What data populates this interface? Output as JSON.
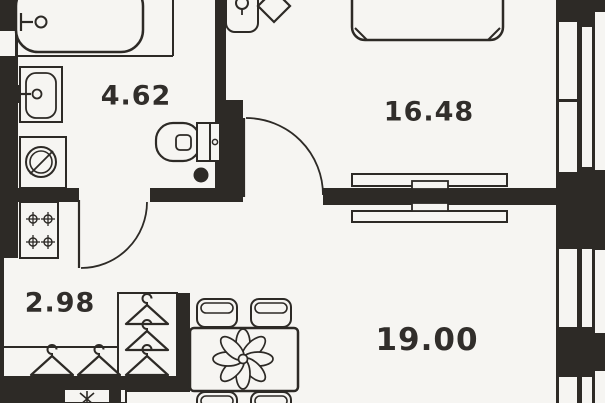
{
  "plan": {
    "type": "apartment-floor-plan",
    "colors": {
      "bg": "#f6f5f2",
      "wall": "#2d2a26",
      "line": "#2d2a26",
      "text": "#312e2b"
    },
    "rooms": [
      {
        "name": "bathroom",
        "area_label": "4.62"
      },
      {
        "name": "bedroom",
        "area_label": "16.48"
      },
      {
        "name": "hallway",
        "area_label": "2.98"
      },
      {
        "name": "living-room",
        "area_label": "19.00"
      }
    ],
    "fixtures": [
      "bathtub-icon",
      "bathroom-sink-icon",
      "washing-machine-icon",
      "toilet-icon",
      "floor-drain-icon",
      "kitchen-sink-icon",
      "entry-door-icon",
      "bathroom-door-icon",
      "bedroom-door-icon",
      "bed-icon",
      "tv-console-icon",
      "tv-icon",
      "stove-icon",
      "hanger-icon",
      "dining-table-icon",
      "flower-centerpiece-icon",
      "chair-icon",
      "window-icon",
      "ventilation-shaft-icon"
    ]
  }
}
